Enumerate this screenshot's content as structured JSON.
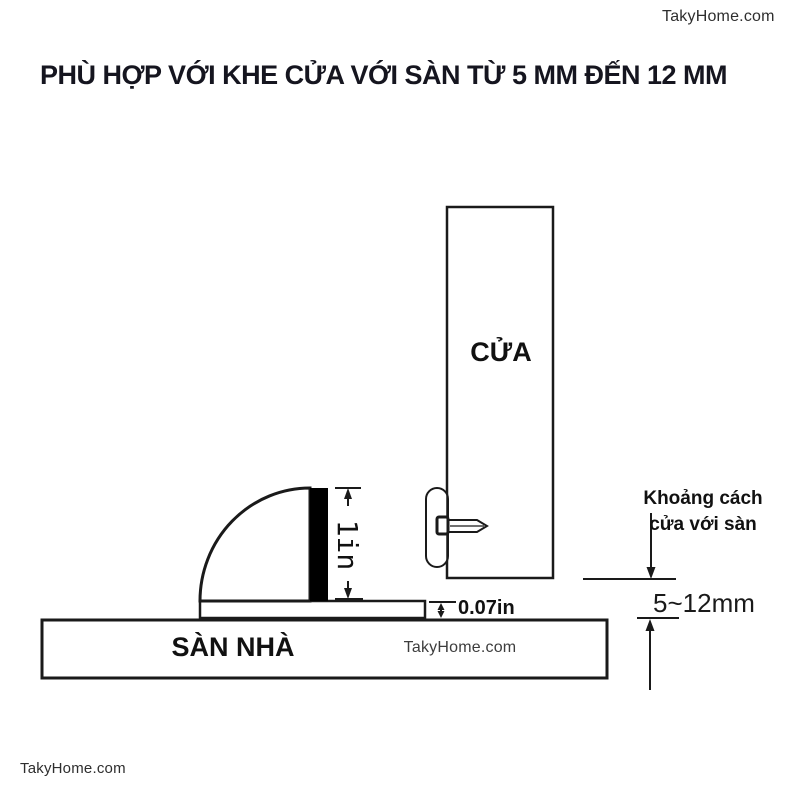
{
  "branding": {
    "top_right": "TakyHome.com",
    "bottom_left": "TakyHome.com",
    "floor_watermark": "TakyHome.com"
  },
  "title": "PHÙ HỢP VỚI KHE CỬA VỚI SÀN TỪ 5 MM ĐẾN 12 MM",
  "diagram": {
    "door_label": "CỬA",
    "floor_label": "SÀN NHÀ",
    "stopper_height_label": "1in",
    "base_thickness_label": "0.07in",
    "gap_note_line1": "Khoảng cách",
    "gap_note_line2": "cửa với sàn",
    "gap_range_label": "5~12mm",
    "gap_range_min_mm": 5,
    "gap_range_max_mm": 12,
    "colors": {
      "line": "#1a1a1a",
      "bar_fill": "#000000",
      "shape_fill": "#ffffff",
      "title_text": "#15151f",
      "watermark_text": "#3d3d3d"
    }
  }
}
